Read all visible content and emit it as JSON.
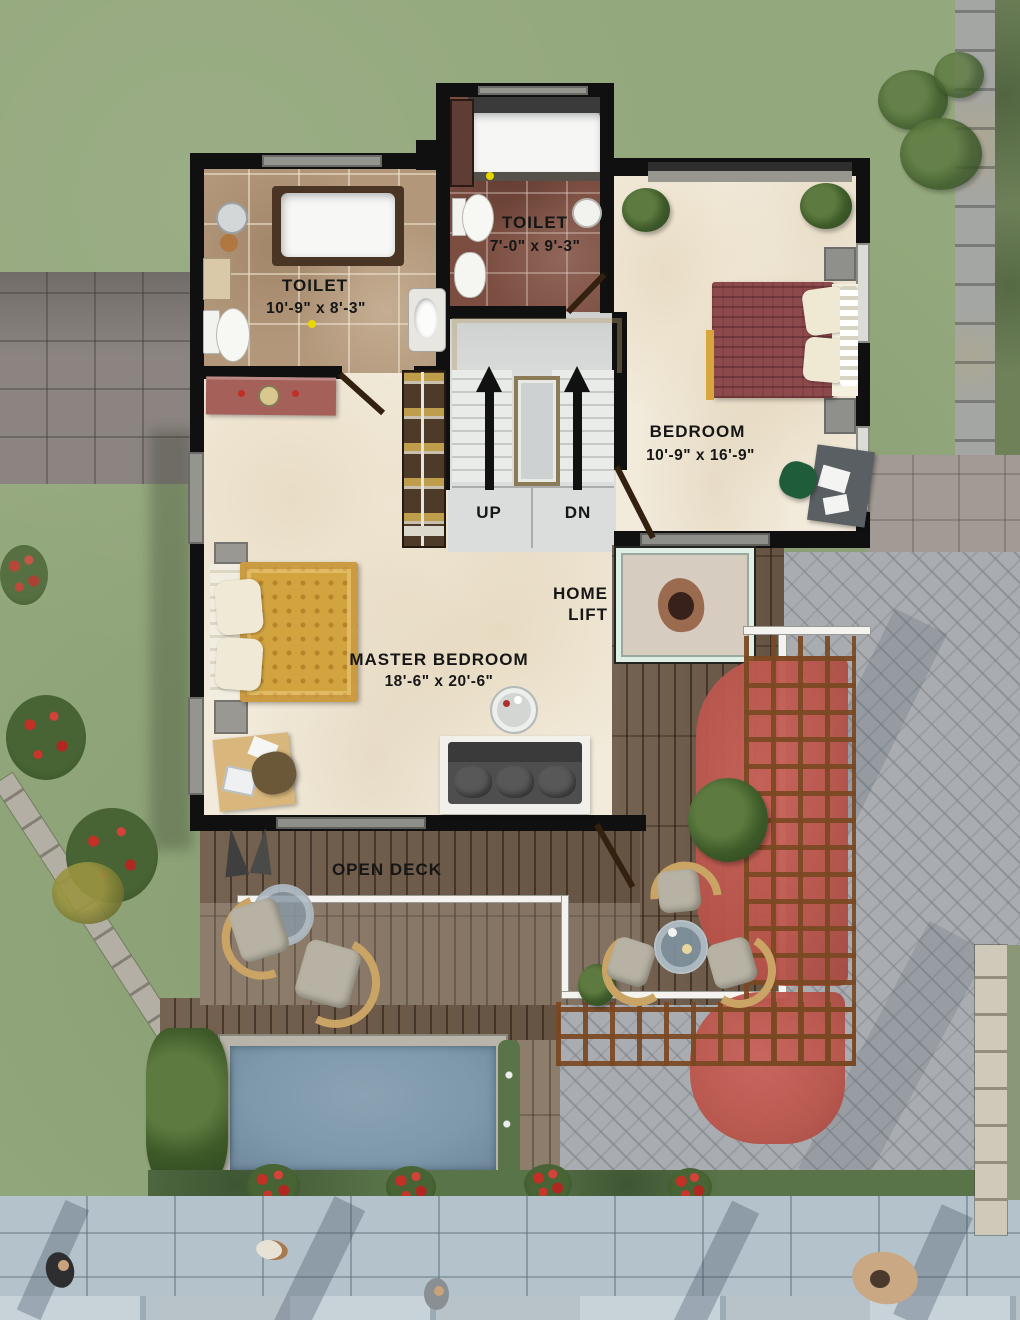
{
  "scene": {
    "type": "residential-floor-plan-3d-render",
    "view": "top-down"
  },
  "rooms": {
    "toilet_left": {
      "label": "TOILET",
      "dimensions": "10'-9\" x 8'-3\""
    },
    "toilet_center": {
      "label": "TOILET",
      "dimensions": "7'-0\" x 9'-3\""
    },
    "bedroom": {
      "label": "BEDROOM",
      "dimensions": "10'-9\" x 16'-9\""
    },
    "master_bedroom": {
      "label": "MASTER BEDROOM",
      "dimensions": "18'-6\" x 20'-6\""
    },
    "open_deck": {
      "label": "OPEN DECK"
    },
    "home_lift": {
      "label_line1": "HOME",
      "label_line2": "LIFT"
    },
    "stairs": {
      "up_label": "UP",
      "down_label": "DN"
    }
  },
  "colors": {
    "wall": "#101010",
    "label_text": "#161616",
    "grass": "#94a87d",
    "deck_wood": "#6e5a48",
    "marble_floor": "#f2ebdb",
    "toilet_left_tile": "#b2977a",
    "toilet_center_tile": "#7b4e41",
    "pool_water": "#7e99ab",
    "pergola_canopy": "#b9544a",
    "bed_blanket_master": "#d2a440",
    "bed_blanket_guest": "#8c4a4c",
    "promenade_tile": "#b4c3cb"
  }
}
